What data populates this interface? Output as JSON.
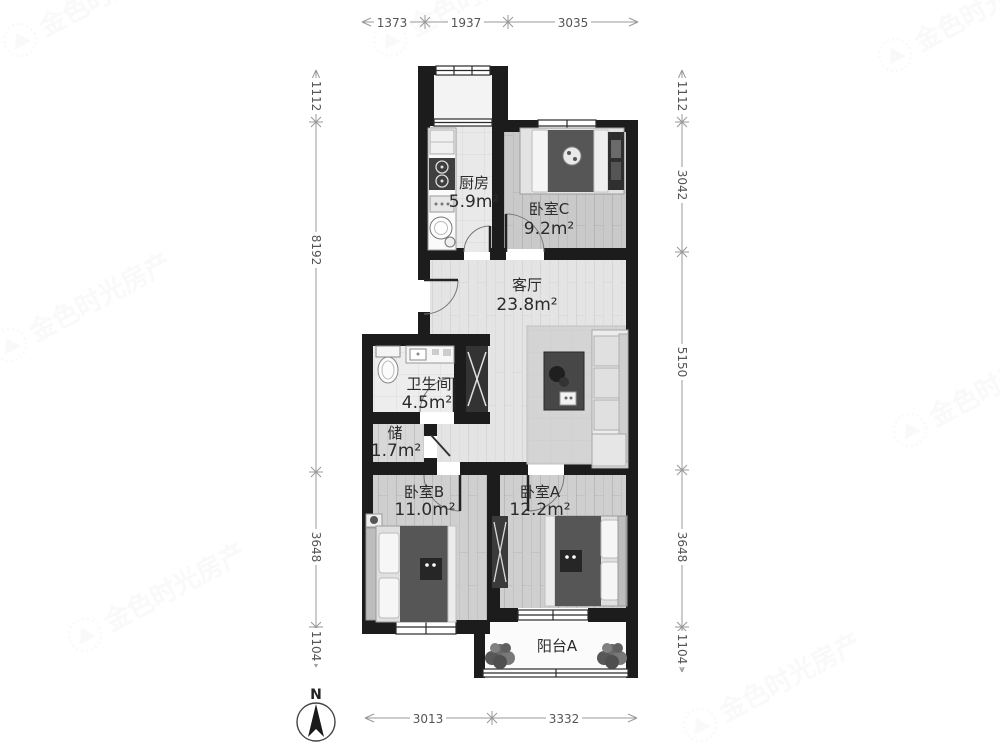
{
  "watermark": {
    "text": "金色时光房产"
  },
  "compass": {
    "label": "N"
  },
  "rooms": [
    {
      "id": "kitchen",
      "name": "厨房",
      "area": "5.9m²"
    },
    {
      "id": "bedroom-c",
      "name": "卧室C",
      "area": "9.2m²"
    },
    {
      "id": "living-room",
      "name": "客厅",
      "area": "23.8m²"
    },
    {
      "id": "bathroom",
      "name": "卫生间",
      "area": "4.5m²"
    },
    {
      "id": "storage",
      "name": "储",
      "area": "1.7m²"
    },
    {
      "id": "bedroom-b",
      "name": "卧室B",
      "area": "11.0m²"
    },
    {
      "id": "bedroom-a",
      "name": "卧室A",
      "area": "12.2m²"
    },
    {
      "id": "balcony",
      "name": "阳台A"
    }
  ],
  "dimensions": {
    "top": [
      "1373",
      "1937",
      "3035"
    ],
    "left": [
      "1112",
      "8192",
      "3648",
      "1104"
    ],
    "right": [
      "1112",
      "3042",
      "5150",
      "3648",
      "1104"
    ],
    "bottom": [
      "3013",
      "3332"
    ]
  },
  "colors": {
    "wall": "#1c1c1c",
    "dimension_line": "#999999",
    "label_text": "#2b2b2b"
  }
}
